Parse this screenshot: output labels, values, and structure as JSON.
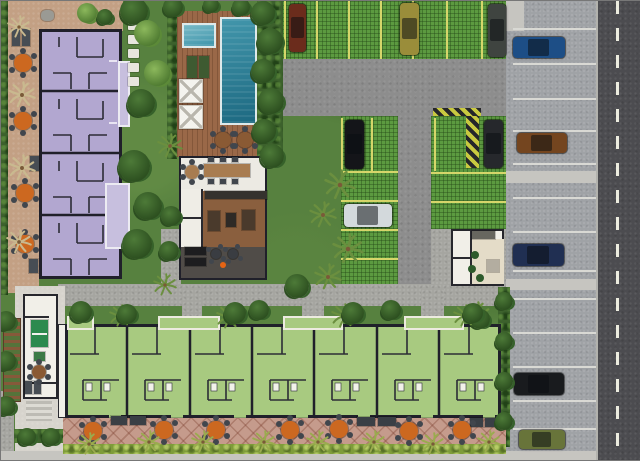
{
  "meta": {
    "description": "Aerial site plan rendering of a residential condominium complex with apartment block, townhouse row, pool deck, clubhouse and parking",
    "canvas": {
      "width": 640,
      "height": 459
    }
  },
  "palette": {
    "landscape": "#57813f",
    "foliage_dark": "#3c612c",
    "hedge_lime": "#7e9c3a",
    "terrace_tan": "#c3a084",
    "terrace_rose": "#c59b8c",
    "apartment_purple": "#b2a7d0",
    "balcony_lavender": "#c7bfde",
    "townhouse_green": "#a8ca80",
    "wall_dark": "#20202a",
    "deck_wood": "#9a6848",
    "paver_green": "#5c9a40",
    "stall_yellow": "#d6d66a",
    "asphalt_gray": "#8d8d8d",
    "road_dark": "#4c4c50",
    "sidewalk_gray": "#9fa2a6",
    "concrete_walk": "#a5a5a0",
    "concrete_light": "#d7d4cd",
    "pad_light": "#c6c5c0",
    "white_structure": "#f1efe8",
    "table_orange": "#cc6820",
    "chair_dark": "#41464d"
  },
  "cars": [
    {
      "x": 288,
      "y": 3,
      "w": 17,
      "h": 48,
      "color": "#6b2c1c"
    },
    {
      "x": 399,
      "y": 2,
      "w": 19,
      "h": 52,
      "color": "#9a8d3a"
    },
    {
      "x": 487,
      "y": 3,
      "w": 18,
      "h": 53,
      "color": "#3f4440"
    },
    {
      "x": 344,
      "y": 119,
      "w": 19,
      "h": 49,
      "color": "#141519"
    },
    {
      "x": 483,
      "y": 119,
      "w": 19,
      "h": 48,
      "color": "#26282c"
    },
    {
      "x": 343,
      "y": 203,
      "w": 48,
      "h": 23,
      "color": "#d3d9dc"
    },
    {
      "x": 512,
      "y": 36,
      "w": 52,
      "h": 21,
      "color": "#1d4e86"
    },
    {
      "x": 516,
      "y": 132,
      "w": 50,
      "h": 20,
      "color": "#74451f"
    },
    {
      "x": 512,
      "y": 243,
      "w": 51,
      "h": 22,
      "color": "#202f52"
    },
    {
      "x": 513,
      "y": 372,
      "w": 50,
      "h": 22,
      "color": "#191b1e"
    },
    {
      "x": 518,
      "y": 429,
      "w": 46,
      "h": 19,
      "color": "#68743a"
    }
  ],
  "markings": [
    {
      "x": 283,
      "y": 0,
      "w": 2,
      "h": 58
    },
    {
      "x": 315,
      "y": 0,
      "w": 2,
      "h": 58
    },
    {
      "x": 347,
      "y": 0,
      "w": 2,
      "h": 58
    },
    {
      "x": 379,
      "y": 0,
      "w": 2,
      "h": 58
    },
    {
      "x": 411,
      "y": 0,
      "w": 2,
      "h": 58
    },
    {
      "x": 445,
      "y": 0,
      "w": 2,
      "h": 58
    },
    {
      "x": 480,
      "y": 0,
      "w": 2,
      "h": 58
    },
    {
      "x": 340,
      "y": 117,
      "w": 2,
      "h": 53
    },
    {
      "x": 370,
      "y": 117,
      "w": 2,
      "h": 53
    },
    {
      "x": 433,
      "y": 117,
      "w": 2,
      "h": 53
    },
    {
      "x": 340,
      "y": 170,
      "w": 57,
      "h": 2
    },
    {
      "x": 340,
      "y": 199,
      "w": 57,
      "h": 2
    },
    {
      "x": 340,
      "y": 228,
      "w": 57,
      "h": 2
    },
    {
      "x": 340,
      "y": 257,
      "w": 57,
      "h": 2
    },
    {
      "x": 430,
      "y": 171,
      "w": 75,
      "h": 2
    },
    {
      "x": 430,
      "y": 200,
      "w": 75,
      "h": 2
    },
    {
      "x": 512,
      "y": 27,
      "w": 83,
      "h": 2,
      "color": "#d9d9d4"
    },
    {
      "x": 512,
      "y": 62,
      "w": 83,
      "h": 2,
      "color": "#d9d9d4"
    },
    {
      "x": 512,
      "y": 97,
      "w": 83,
      "h": 2,
      "color": "#d9d9d4"
    },
    {
      "x": 512,
      "y": 129,
      "w": 83,
      "h": 2,
      "color": "#d9d9d4"
    },
    {
      "x": 512,
      "y": 162,
      "w": 83,
      "h": 2,
      "color": "#d9d9d4"
    },
    {
      "x": 512,
      "y": 196,
      "w": 83,
      "h": 2,
      "color": "#d9d9d4"
    },
    {
      "x": 512,
      "y": 230,
      "w": 83,
      "h": 2,
      "color": "#d9d9d4"
    },
    {
      "x": 512,
      "y": 269,
      "w": 83,
      "h": 2,
      "color": "#d9d9d4"
    },
    {
      "x": 512,
      "y": 297,
      "w": 83,
      "h": 2,
      "color": "#d9d9d4"
    },
    {
      "x": 512,
      "y": 331,
      "w": 83,
      "h": 2,
      "color": "#d9d9d4"
    },
    {
      "x": 512,
      "y": 365,
      "w": 83,
      "h": 2,
      "color": "#d9d9d4"
    },
    {
      "x": 512,
      "y": 399,
      "w": 83,
      "h": 2,
      "color": "#d9d9d4"
    },
    {
      "x": 512,
      "y": 427,
      "w": 83,
      "h": 2,
      "color": "#d9d9d4"
    },
    {
      "x": 595,
      "y": 0,
      "w": 2,
      "h": 459,
      "color": "#b2b2ad"
    }
  ],
  "round_tables": [
    {
      "x": 22,
      "y": 62,
      "r": 9,
      "color": "#cc6820"
    },
    {
      "x": 22,
      "y": 120,
      "r": 9,
      "color": "#cc6820"
    },
    {
      "x": 24,
      "y": 192,
      "r": 9,
      "color": "#cc6820"
    },
    {
      "x": 24,
      "y": 243,
      "r": 9,
      "color": "#cc6820"
    },
    {
      "x": 92,
      "y": 430,
      "r": 9,
      "color": "#cc6820"
    },
    {
      "x": 163,
      "y": 429,
      "r": 9,
      "color": "#cc6820"
    },
    {
      "x": 215,
      "y": 429,
      "r": 9,
      "color": "#cc6820"
    },
    {
      "x": 289,
      "y": 429,
      "r": 9,
      "color": "#cc6820"
    },
    {
      "x": 338,
      "y": 428,
      "r": 9,
      "color": "#cc6820"
    },
    {
      "x": 408,
      "y": 430,
      "r": 9,
      "color": "#cc6820"
    },
    {
      "x": 461,
      "y": 429,
      "r": 9,
      "color": "#cc6820"
    },
    {
      "x": 222,
      "y": 139,
      "r": 8,
      "color": "#8a5a34"
    },
    {
      "x": 244,
      "y": 139,
      "r": 8,
      "color": "#8a5a34"
    },
    {
      "x": 191,
      "y": 171,
      "r": 7,
      "color": "#a87c50"
    },
    {
      "x": 215,
      "y": 253,
      "r": 5,
      "color": "#3a3d42"
    },
    {
      "x": 232,
      "y": 253,
      "r": 5,
      "color": "#3a3d42"
    },
    {
      "x": 38,
      "y": 371,
      "r": 7,
      "color": "#8a5a34"
    }
  ],
  "furniture_rects": [
    {
      "x": 11,
      "y": 28,
      "w": 8,
      "h": 17,
      "color": "#474d54"
    },
    {
      "x": 21,
      "y": 28,
      "w": 8,
      "h": 17,
      "color": "#474d54"
    },
    {
      "x": 29,
      "y": 155,
      "w": 9,
      "h": 15,
      "color": "#474d54"
    },
    {
      "x": 28,
      "y": 258,
      "w": 9,
      "h": 14,
      "color": "#474d54"
    },
    {
      "x": 24,
      "y": 380,
      "w": 7,
      "h": 13,
      "color": "#474d54"
    },
    {
      "x": 33,
      "y": 380,
      "w": 7,
      "h": 13,
      "color": "#474d54"
    },
    {
      "x": 186,
      "y": 55,
      "w": 10,
      "h": 22,
      "color": "#3e5a31"
    },
    {
      "x": 198,
      "y": 55,
      "w": 10,
      "h": 22,
      "color": "#3e5a31"
    },
    {
      "x": 178,
      "y": 78,
      "w": 24,
      "h": 24,
      "color": "#f4f3ee",
      "cls": "daybed"
    },
    {
      "x": 178,
      "y": 104,
      "w": 24,
      "h": 24,
      "color": "#f4f3ee",
      "cls": "daybed"
    },
    {
      "x": 203,
      "y": 163,
      "w": 46,
      "h": 13,
      "color": "#a87c50"
    },
    {
      "x": 207,
      "y": 156,
      "w": 6,
      "h": 5,
      "color": "#41464d"
    },
    {
      "x": 219,
      "y": 156,
      "w": 6,
      "h": 5,
      "color": "#41464d"
    },
    {
      "x": 231,
      "y": 156,
      "w": 6,
      "h": 5,
      "color": "#41464d"
    },
    {
      "x": 207,
      "y": 178,
      "w": 6,
      "h": 5,
      "color": "#41464d"
    },
    {
      "x": 219,
      "y": 178,
      "w": 6,
      "h": 5,
      "color": "#41464d"
    },
    {
      "x": 231,
      "y": 178,
      "w": 6,
      "h": 5,
      "color": "#41464d"
    },
    {
      "x": 204,
      "y": 190,
      "w": 62,
      "h": 8,
      "color": "#35322e"
    },
    {
      "x": 207,
      "y": 210,
      "w": 12,
      "h": 20,
      "color": "#4a3a2c"
    },
    {
      "x": 225,
      "y": 212,
      "w": 10,
      "h": 14,
      "color": "#2e2a26"
    },
    {
      "x": 241,
      "y": 209,
      "w": 13,
      "h": 20,
      "color": "#4a3a2c"
    },
    {
      "x": 184,
      "y": 246,
      "w": 21,
      "h": 8,
      "color": "#1d1d1f"
    },
    {
      "x": 184,
      "y": 257,
      "w": 21,
      "h": 8,
      "color": "#1d1d1f"
    },
    {
      "x": 110,
      "y": 415,
      "w": 16,
      "h": 9,
      "color": "#3a3f45"
    },
    {
      "x": 129,
      "y": 415,
      "w": 16,
      "h": 9,
      "color": "#3a3f45"
    },
    {
      "x": 356,
      "y": 416,
      "w": 18,
      "h": 9,
      "color": "#3a3f45"
    },
    {
      "x": 377,
      "y": 416,
      "w": 18,
      "h": 9,
      "color": "#3a3f45"
    },
    {
      "x": 469,
      "y": 417,
      "w": 13,
      "h": 9,
      "color": "#3a3f45"
    },
    {
      "x": 484,
      "y": 417,
      "w": 13,
      "h": 9,
      "color": "#3a3f45"
    },
    {
      "x": 30,
      "y": 319,
      "w": 17,
      "h": 27,
      "color": "#2c8a4e",
      "cls": "pingpong"
    },
    {
      "x": 33,
      "y": 351,
      "w": 11,
      "h": 9,
      "color": "#3c7a45"
    },
    {
      "x": 471,
      "y": 230,
      "w": 23,
      "h": 8,
      "color": "#67665f"
    },
    {
      "x": 486,
      "y": 259,
      "w": 12,
      "h": 12,
      "color": "#b3ada0"
    },
    {
      "x": 40,
      "y": 9,
      "w": 13,
      "h": 11,
      "color": "#9a9a94",
      "cls": "round"
    }
  ],
  "dots": [
    {
      "x": 222,
      "y": 264,
      "r": 3,
      "color": "#e66414"
    },
    {
      "x": 474,
      "y": 254,
      "r": 4,
      "color": "#2d5a2b"
    },
    {
      "x": 471,
      "y": 268,
      "r": 4,
      "color": "#2d5a2b"
    },
    {
      "x": 479,
      "y": 277,
      "r": 4,
      "color": "#2d5a2b"
    }
  ],
  "stepping_stones": [
    {
      "x": 127,
      "y": 20
    },
    {
      "x": 127,
      "y": 34
    },
    {
      "x": 127,
      "y": 48
    },
    {
      "x": 127,
      "y": 62
    },
    {
      "x": 127,
      "y": 76
    }
  ],
  "vegetation": [
    {
      "x": 6,
      "y": 14,
      "r": 12,
      "kind": "drypalm"
    },
    {
      "x": 7,
      "y": 80,
      "r": 14,
      "kind": "drypalm"
    },
    {
      "x": 7,
      "y": 153,
      "r": 14,
      "kind": "drypalm"
    },
    {
      "x": 5,
      "y": 228,
      "r": 13,
      "kind": "drypalm"
    },
    {
      "x": 86,
      "y": 12,
      "r": 10,
      "kind": "canopy"
    },
    {
      "x": 104,
      "y": 16,
      "r": 8,
      "kind": "bush"
    },
    {
      "x": 133,
      "y": 10,
      "r": 14,
      "kind": "bush"
    },
    {
      "x": 146,
      "y": 32,
      "r": 13,
      "kind": "canopy"
    },
    {
      "x": 156,
      "y": 72,
      "r": 13,
      "kind": "canopy"
    },
    {
      "x": 140,
      "y": 102,
      "r": 14,
      "kind": "bush"
    },
    {
      "x": 156,
      "y": 132,
      "r": 13,
      "kind": "palm"
    },
    {
      "x": 133,
      "y": 165,
      "r": 16,
      "kind": "bush"
    },
    {
      "x": 147,
      "y": 205,
      "r": 14,
      "kind": "bush"
    },
    {
      "x": 136,
      "y": 243,
      "r": 15,
      "kind": "bush"
    },
    {
      "x": 152,
      "y": 272,
      "r": 12,
      "kind": "palm"
    },
    {
      "x": 172,
      "y": 6,
      "r": 10,
      "kind": "bush"
    },
    {
      "x": 210,
      "y": 4,
      "r": 8,
      "kind": "bush"
    },
    {
      "x": 240,
      "y": 6,
      "r": 9,
      "kind": "bush"
    },
    {
      "x": 262,
      "y": 12,
      "r": 12,
      "kind": "bush"
    },
    {
      "x": 269,
      "y": 40,
      "r": 13,
      "kind": "bush"
    },
    {
      "x": 262,
      "y": 70,
      "r": 12,
      "kind": "bush"
    },
    {
      "x": 270,
      "y": 100,
      "r": 13,
      "kind": "bush"
    },
    {
      "x": 263,
      "y": 130,
      "r": 12,
      "kind": "bush"
    },
    {
      "x": 271,
      "y": 155,
      "r": 12,
      "kind": "bush"
    },
    {
      "x": 170,
      "y": 215,
      "r": 10,
      "kind": "bush"
    },
    {
      "x": 168,
      "y": 250,
      "r": 10,
      "kind": "bush"
    },
    {
      "x": 323,
      "y": 168,
      "r": 16,
      "kind": "palm"
    },
    {
      "x": 308,
      "y": 200,
      "r": 14,
      "kind": "palm"
    },
    {
      "x": 331,
      "y": 232,
      "r": 16,
      "kind": "palm"
    },
    {
      "x": 313,
      "y": 262,
      "r": 14,
      "kind": "palm"
    },
    {
      "x": 296,
      "y": 285,
      "r": 12,
      "kind": "bush"
    },
    {
      "x": 462,
      "y": 300,
      "r": 14,
      "kind": "palm"
    },
    {
      "x": 479,
      "y": 318,
      "r": 10,
      "kind": "bush"
    },
    {
      "x": 80,
      "y": 311,
      "r": 11,
      "kind": "bush"
    },
    {
      "x": 108,
      "y": 303,
      "r": 12,
      "kind": "palm"
    },
    {
      "x": 126,
      "y": 313,
      "r": 10,
      "kind": "bush"
    },
    {
      "x": 215,
      "y": 303,
      "r": 13,
      "kind": "palm"
    },
    {
      "x": 234,
      "y": 312,
      "r": 11,
      "kind": "bush"
    },
    {
      "x": 258,
      "y": 309,
      "r": 10,
      "kind": "bush"
    },
    {
      "x": 330,
      "y": 302,
      "r": 13,
      "kind": "palm"
    },
    {
      "x": 352,
      "y": 312,
      "r": 11,
      "kind": "bush"
    },
    {
      "x": 390,
      "y": 309,
      "r": 10,
      "kind": "bush"
    },
    {
      "x": 452,
      "y": 303,
      "r": 12,
      "kind": "palm"
    },
    {
      "x": 472,
      "y": 312,
      "r": 10,
      "kind": "bush"
    },
    {
      "x": 76,
      "y": 431,
      "r": 12,
      "kind": "palm2"
    },
    {
      "x": 136,
      "y": 429,
      "r": 12,
      "kind": "palm2"
    },
    {
      "x": 190,
      "y": 429,
      "r": 12,
      "kind": "palm2"
    },
    {
      "x": 251,
      "y": 429,
      "r": 12,
      "kind": "palm2"
    },
    {
      "x": 305,
      "y": 429,
      "r": 12,
      "kind": "palm2"
    },
    {
      "x": 361,
      "y": 429,
      "r": 12,
      "kind": "palm2"
    },
    {
      "x": 420,
      "y": 431,
      "r": 12,
      "kind": "palm2"
    },
    {
      "x": 476,
      "y": 429,
      "r": 12,
      "kind": "palm2"
    },
    {
      "x": 503,
      "y": 300,
      "r": 9,
      "kind": "bush"
    },
    {
      "x": 503,
      "y": 340,
      "r": 9,
      "kind": "bush"
    },
    {
      "x": 503,
      "y": 380,
      "r": 9,
      "kind": "bush"
    },
    {
      "x": 503,
      "y": 420,
      "r": 9,
      "kind": "bush"
    },
    {
      "x": 5,
      "y": 320,
      "r": 10,
      "kind": "bush"
    },
    {
      "x": 5,
      "y": 360,
      "r": 10,
      "kind": "bush"
    },
    {
      "x": 5,
      "y": 405,
      "r": 10,
      "kind": "bush"
    },
    {
      "x": 26,
      "y": 436,
      "r": 9,
      "kind": "bush"
    },
    {
      "x": 50,
      "y": 436,
      "r": 9,
      "kind": "bush"
    }
  ],
  "palm_colors": {
    "palm": "#6b8f3f",
    "palm2": "#9aab4e",
    "drypalm": "#c9b98f"
  }
}
